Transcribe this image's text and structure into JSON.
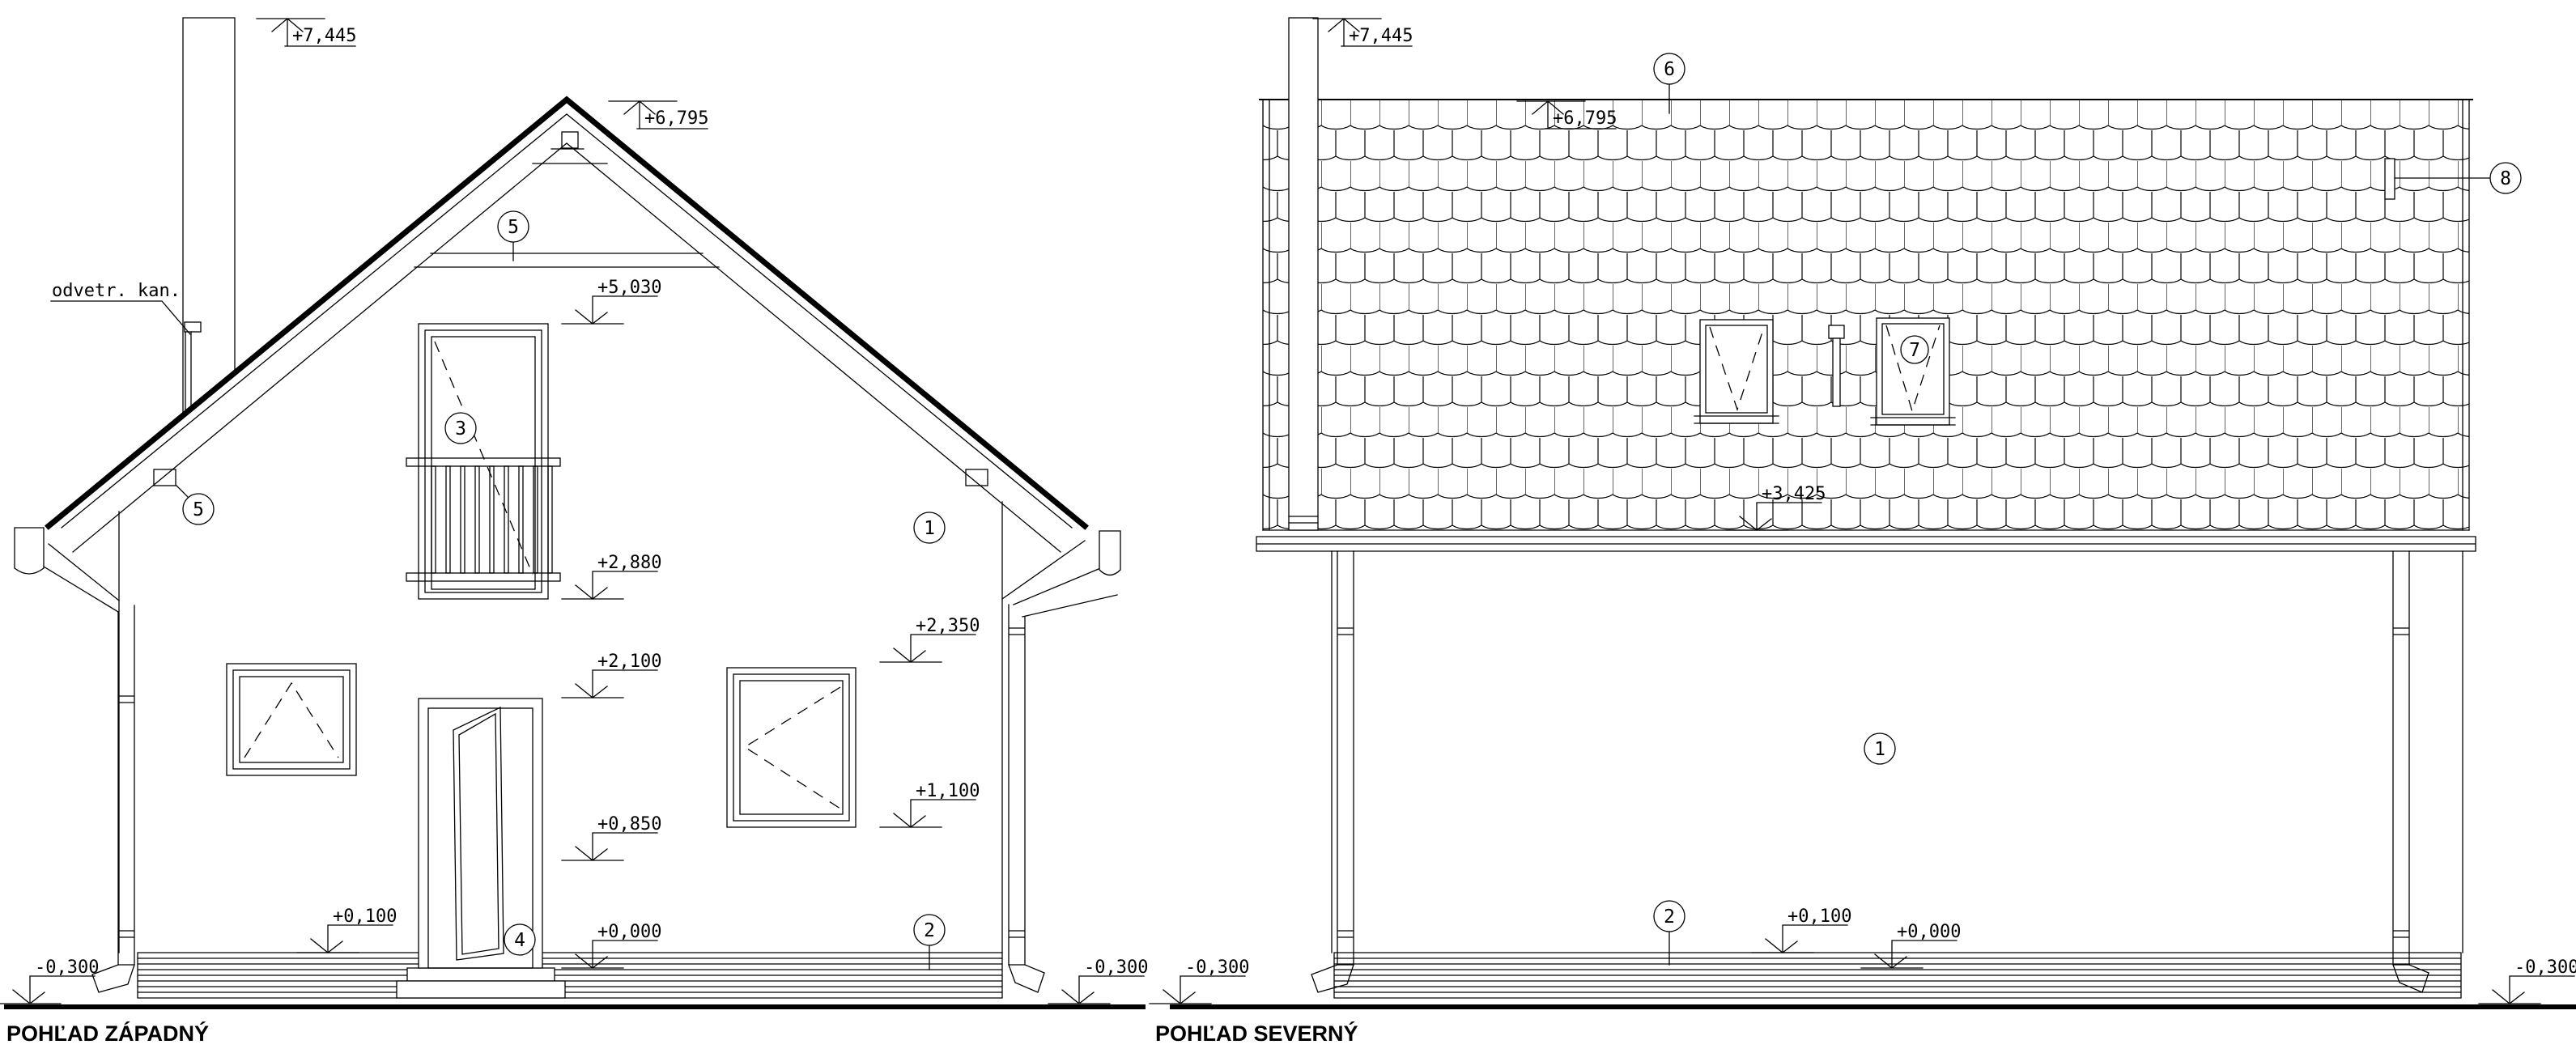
{
  "drawing_type": "house elevation blueprint",
  "line_color": "#000000",
  "paper_color": "#ffffff",
  "west": {
    "title": "POHĽAD ZÁPADNÝ",
    "vent_duct_label": "odvetr. kan.",
    "levels": {
      "chimney_top": "+7,445",
      "ridge": "+6,795",
      "collar_tie": "+5,030",
      "balcony_floor": "+2,880",
      "window_head_right": "+2,350",
      "door_head": "+2,100",
      "window_sill_right": "+1,100",
      "window_sill_left": "+0,850",
      "plinth_top": "+0,100",
      "floor": "+0,000",
      "terrain_left": "-0,300",
      "terrain_right": "-0,300"
    },
    "callouts": {
      "collar_tie": "5",
      "balcony_door": "3",
      "snow_guard": "5",
      "facade_wall": "1",
      "plinth": "2",
      "entry_door": "4"
    }
  },
  "north": {
    "title": "POHĽAD SEVERNÝ",
    "levels": {
      "chimney_top": "+7,445",
      "ridge": "+6,795",
      "eave": "+3,425",
      "plinth_top": "+0,100",
      "floor": "+0,000",
      "terrain_left": "-0,300",
      "terrain_right": "-0,300"
    },
    "callouts": {
      "roof": "6",
      "roof_window": "7",
      "snow_stop": "8",
      "facade_wall": "1",
      "plinth": "2"
    }
  }
}
